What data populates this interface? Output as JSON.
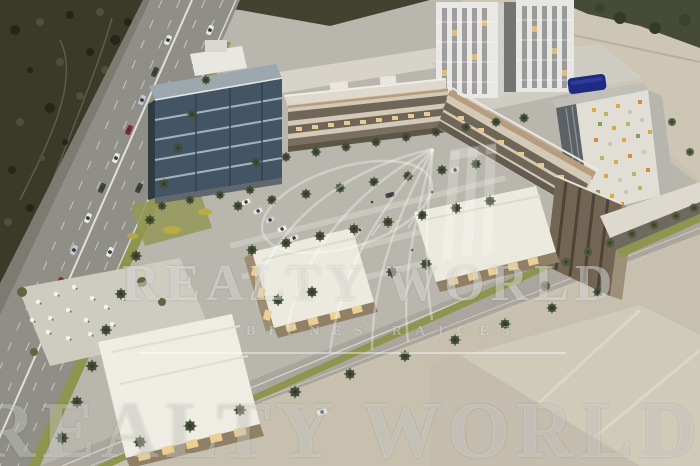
{
  "image": {
    "kind": "architectural aerial rendering",
    "subject": "mixed-use commercial development beside a highway"
  },
  "watermark": {
    "brand": "REALTY WORLD",
    "subtitle": "BIENES RAICES",
    "color": "#ffffff"
  },
  "palette": {
    "land_beige": "#c7c0af",
    "site_gray": "#b7b4ab",
    "scrub_dark": "#34311f",
    "highway_gray": "#8b8a83",
    "glass_blue": "#3c4e5f",
    "facade_cream": "#d2c7b5",
    "roof_white": "#eceade",
    "wood_trim": "#b59a77",
    "palm_green": "#3e4930",
    "verge_green": "#8a9148",
    "hotel_sign_blue": "#16227d",
    "mosaic_gold": "#d7a73e",
    "lit_window": "#e8c98a"
  }
}
